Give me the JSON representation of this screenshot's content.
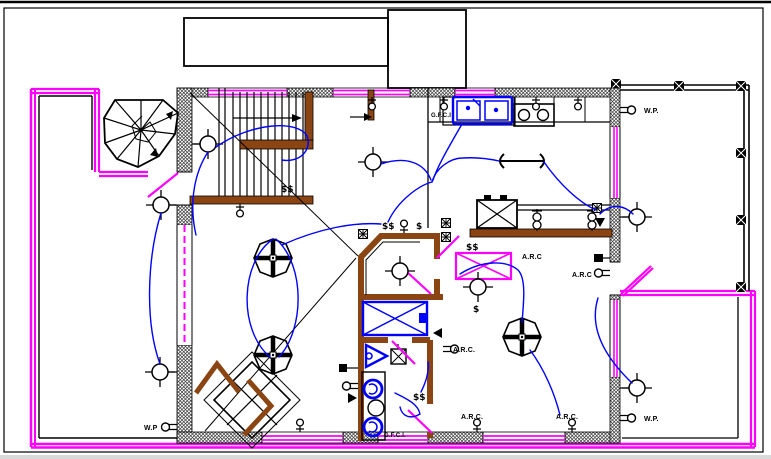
{
  "drawing": {
    "labels": [
      {
        "id": "wp-top-right",
        "text": "W.P."
      },
      {
        "id": "wp-bottom-right",
        "text": "W.P."
      },
      {
        "id": "wp-bottom-left",
        "text": "W.P"
      },
      {
        "id": "gfci-kitchen",
        "text": "G.F.C.I"
      },
      {
        "id": "gfci-bathroom",
        "text": "G.F.C.I."
      },
      {
        "id": "arc-bar-counter",
        "text": "A.R.C"
      },
      {
        "id": "arc-right-wall",
        "text": "A.R.C"
      },
      {
        "id": "arc-bathroom-wall",
        "text": "A.R.C."
      },
      {
        "id": "arc-bottom-wall-left",
        "text": "A.R.C."
      },
      {
        "id": "arc-bottom-wall-right",
        "text": "A.R.C."
      }
    ],
    "symbols": {
      "switch": "$",
      "switch_pair": "$$"
    },
    "colors": {
      "wiring": "#0000ff",
      "fixture": "#0000ff",
      "railing": "#ff00ff",
      "casework": "#8b4513",
      "wall": "#000000",
      "background": "#ffffff"
    }
  }
}
